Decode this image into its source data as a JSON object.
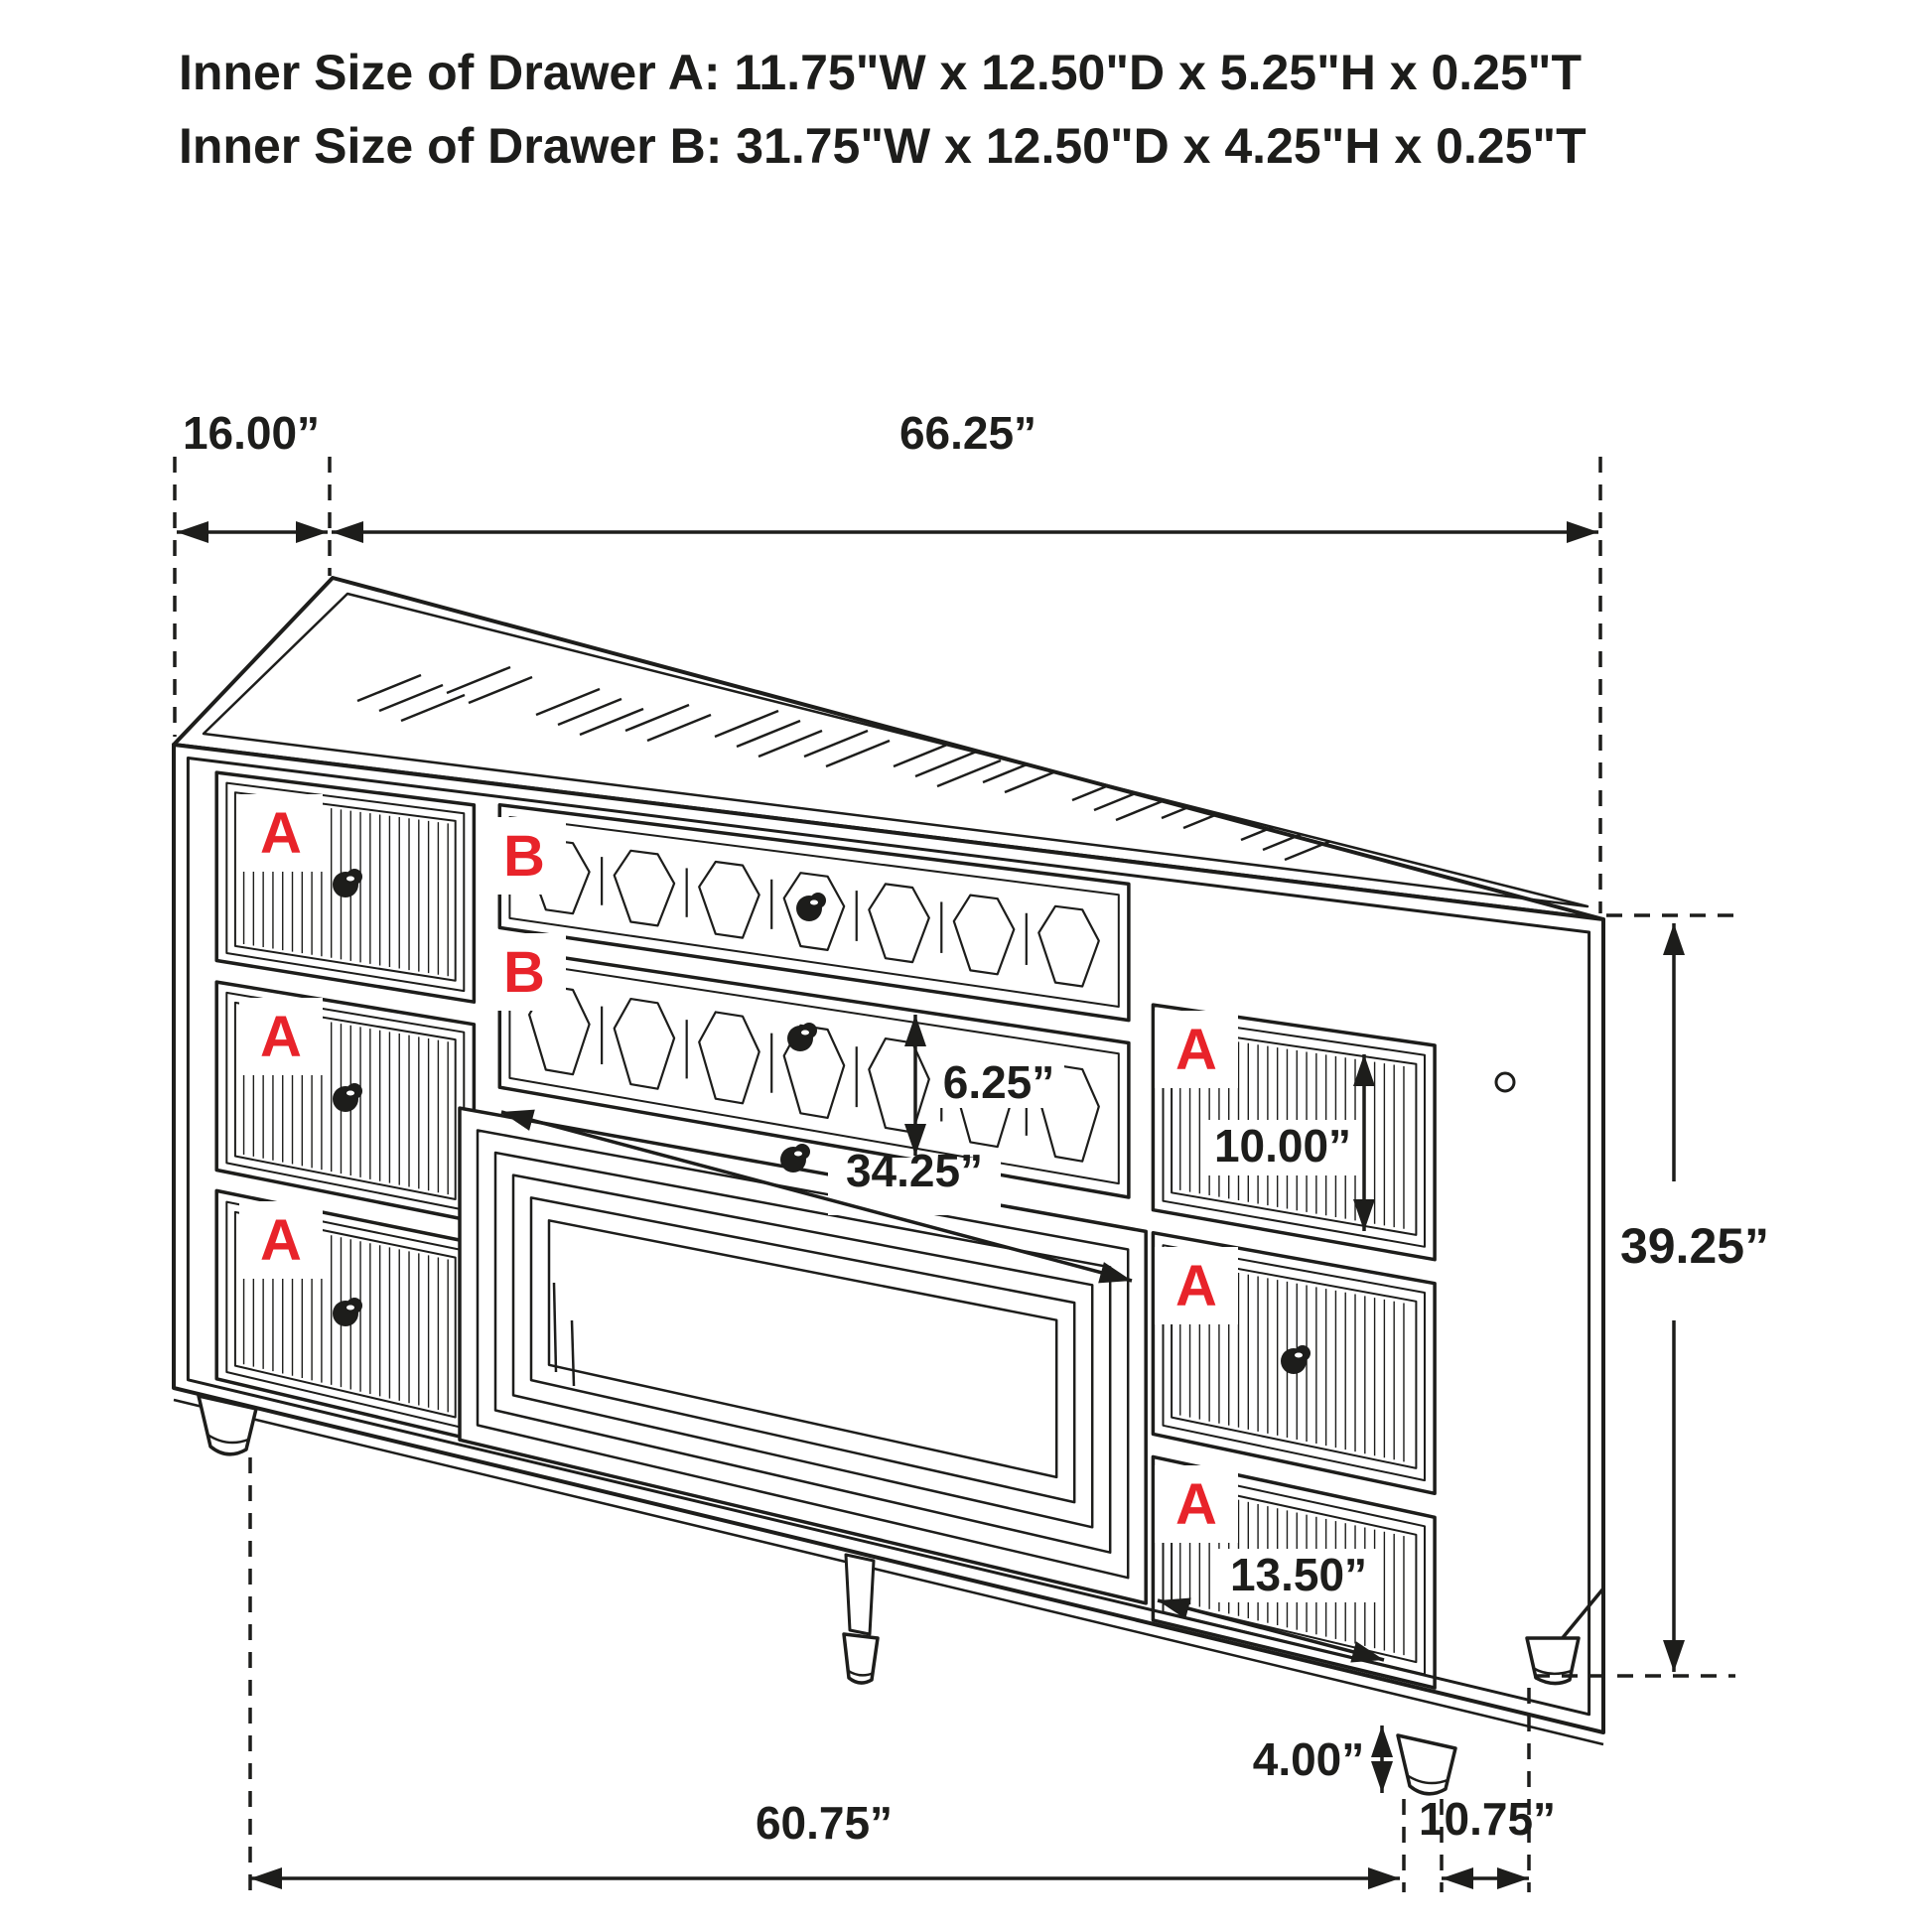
{
  "title": {
    "line1": "Inner Size of Drawer A: 11.75\"W x 12.50\"D x 5.25\"H x 0.25\"T",
    "line2": "Inner Size of Drawer B: 31.75\"W x 12.50\"D x 4.25\"H x 0.25\"T"
  },
  "drawer_labels": {
    "a": "A",
    "b": "B"
  },
  "dimensions": {
    "top_depth": "16.00”",
    "top_width": "66.25”",
    "overall_height": "39.25”",
    "b_drawer_height": "6.25”",
    "b_drawer_width": "34.25”",
    "right_top_drawer_height": "10.00”",
    "right_bottom_drawer_width": "13.50”",
    "foot_height": "4.00”",
    "bottom_width": "60.75”",
    "bottom_depth": "10.75”"
  },
  "colors": {
    "line": "#1d1d1b",
    "letter_red": "#e8232a",
    "background": "#ffffff"
  }
}
